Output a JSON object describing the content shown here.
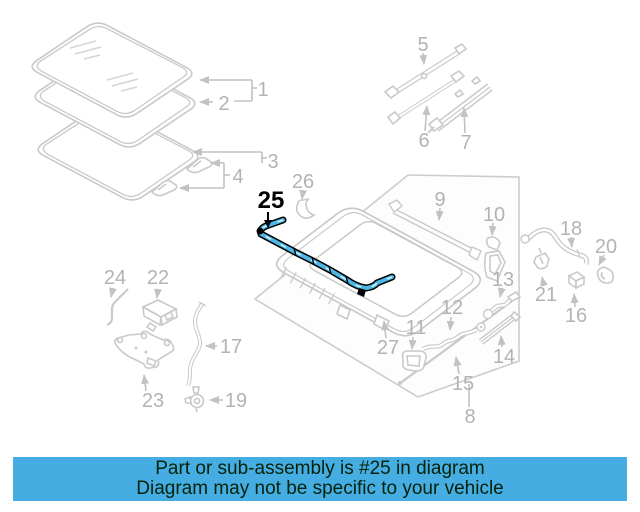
{
  "banner": {
    "line1": "Part or sub-assembly is #25 in diagram",
    "line2": "Diagram may not be specific to your vehicle",
    "bg_color": "#45ade2",
    "text_color": "#05220a"
  },
  "highlight": {
    "part_number": "25",
    "fill_color": "#4bb7e6",
    "outline_color": "#000000"
  },
  "colors": {
    "diagram_gray": "#c9c9c9",
    "callout_gray": "#c2c2c2",
    "label_gray": "#b3b3b3",
    "background": "#ffffff"
  },
  "callouts": {
    "1": "1",
    "2": "2",
    "3": "3",
    "4": "4",
    "5": "5",
    "6": "6",
    "7": "7",
    "8": "8",
    "9": "9",
    "10": "10",
    "11": "11",
    "12": "12",
    "13": "13",
    "14": "14",
    "15": "15",
    "16": "16",
    "17": "17",
    "18": "18",
    "19": "19",
    "20": "20",
    "21": "21",
    "22": "22",
    "23": "23",
    "24": "24",
    "25": "25",
    "26": "26",
    "27": "27"
  }
}
